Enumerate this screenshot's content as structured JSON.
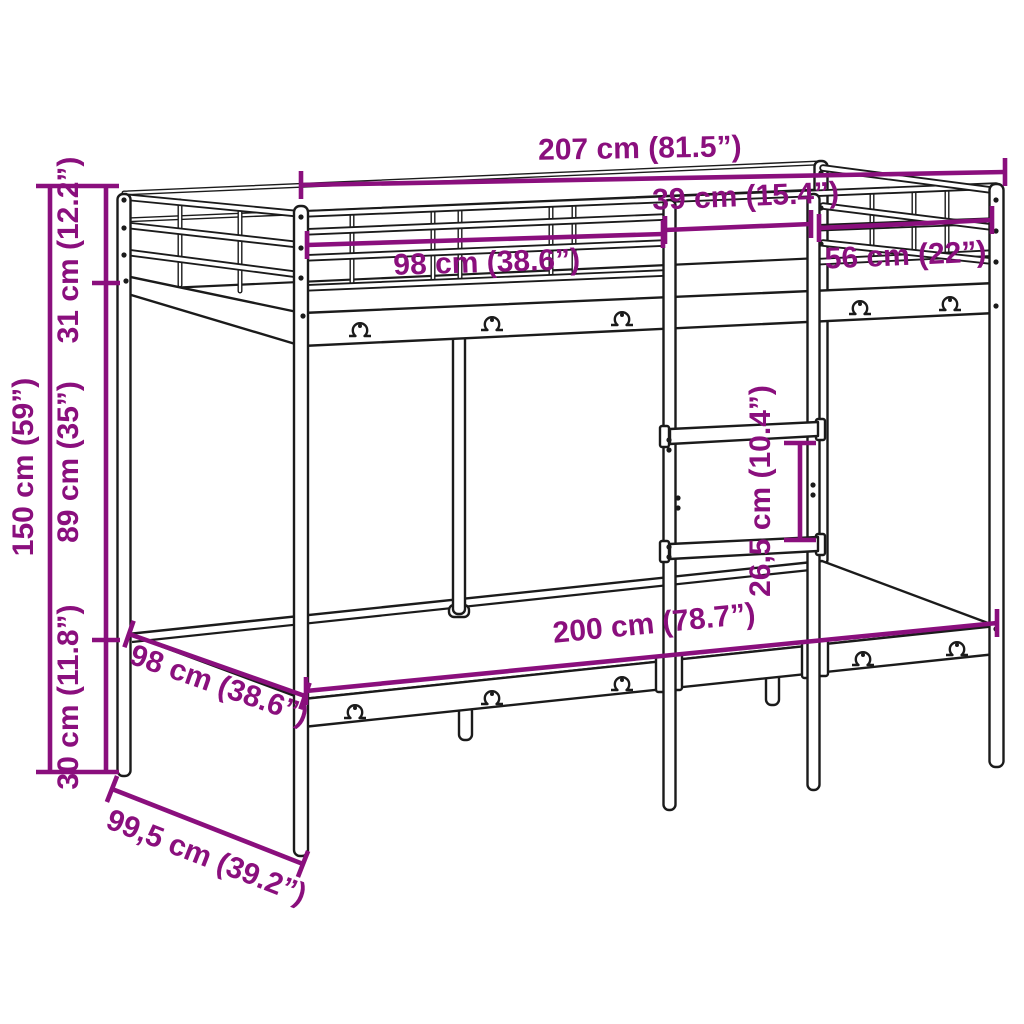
{
  "diagram": {
    "title": "Metal loft bed frame with ladder — dimension diagram",
    "background_color": "#ffffff",
    "line_color": "#1b1b1b",
    "accent_color": "#8a0f7d",
    "dimensions": {
      "total_length": {
        "label": "207 cm (81.5”)",
        "cm": 207,
        "inches": 81.5
      },
      "section_left": {
        "label": "98 cm (38.6”)",
        "cm": 98,
        "inches": 38.6
      },
      "ladder_width": {
        "label": "39 cm (15.4”)",
        "cm": 39,
        "inches": 15.4
      },
      "section_right": {
        "label": "56 cm (22”)",
        "cm": 56,
        "inches": 22
      },
      "total_height": {
        "label": "150 cm (59”)",
        "cm": 150,
        "inches": 59
      },
      "guardrail_height": {
        "label": "31 cm (12.2”)",
        "cm": 31,
        "inches": 12.2
      },
      "under_bed_clearance": {
        "label": "89 cm (35”)",
        "cm": 89,
        "inches": 35
      },
      "base_height": {
        "label": "30 cm (11.8”)",
        "cm": 30,
        "inches": 11.8
      },
      "bed_length": {
        "label": "200 cm (78.7”)",
        "cm": 200,
        "inches": 78.7
      },
      "bed_width": {
        "label": "98 cm (38.6”)",
        "cm": 98,
        "inches": 38.6
      },
      "total_width": {
        "label": "99,5 cm (39.2”)",
        "cm": 99.5,
        "inches": 39.2
      },
      "ladder_rung_spacing": {
        "label": "26,5 cm (10.4”)",
        "cm": 26.5,
        "inches": 10.4
      }
    }
  }
}
